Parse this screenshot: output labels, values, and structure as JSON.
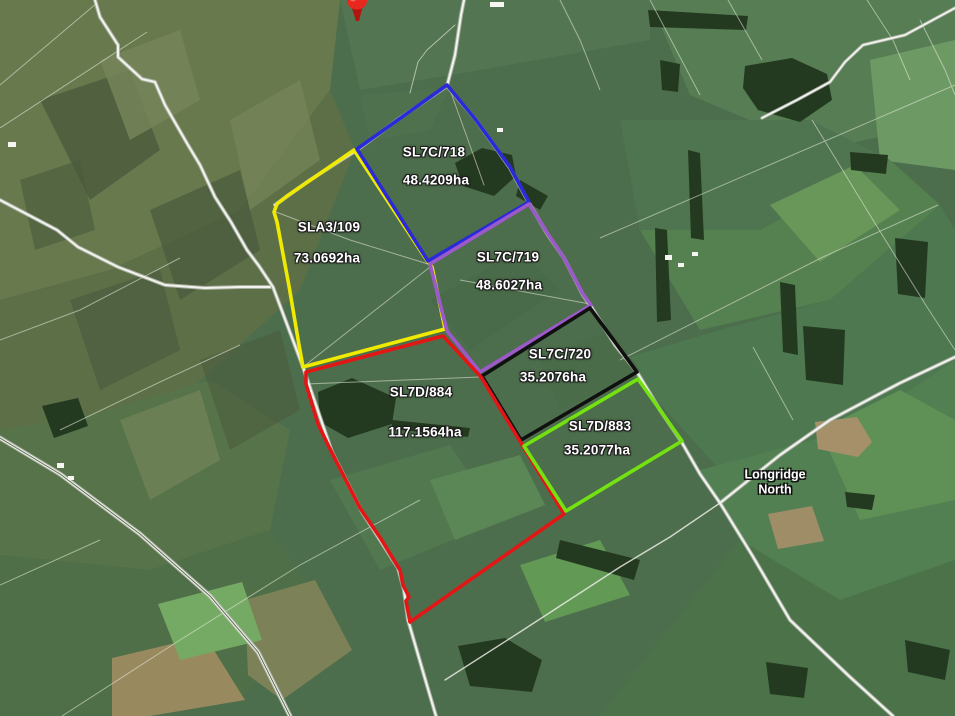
{
  "place_label": {
    "lines": [
      "Longridge",
      "North"
    ],
    "x": 775,
    "y": 482
  },
  "marker": {
    "name": "red-map-pin",
    "color": "#e8281e",
    "x": 357,
    "y": 2
  },
  "label_style": {
    "text_color": "#ffffff",
    "halo_color": "#111111"
  },
  "parcels": [
    {
      "id": "SLA3/109",
      "area": "73.0692ha",
      "outline_color": "#f0ea00",
      "id_pos": {
        "x": 329,
        "y": 227
      },
      "area_pos": {
        "x": 327,
        "y": 258
      },
      "polygon": [
        [
          354,
          150
        ],
        [
          428,
          262
        ],
        [
          432,
          267
        ],
        [
          445,
          329
        ],
        [
          303,
          367
        ],
        [
          299,
          345
        ],
        [
          289,
          286
        ],
        [
          277,
          222
        ],
        [
          274,
          212
        ],
        [
          277,
          204
        ],
        [
          287,
          196
        ],
        [
          312,
          179
        ]
      ]
    },
    {
      "id": "SL7C/718",
      "area": "48.4209ha",
      "outline_color": "#2a2ad8",
      "id_pos": {
        "x": 434,
        "y": 152
      },
      "area_pos": {
        "x": 436,
        "y": 180
      },
      "polygon": [
        [
          447,
          85
        ],
        [
          476,
          120
        ],
        [
          510,
          167
        ],
        [
          529,
          202
        ],
        [
          428,
          261
        ],
        [
          357,
          149
        ]
      ]
    },
    {
      "id": "SL7C/719",
      "area": "48.6027ha",
      "outline_color": "#9b59c9",
      "id_pos": {
        "x": 508,
        "y": 257
      },
      "area_pos": {
        "x": 509,
        "y": 285
      },
      "polygon": [
        [
          430,
          264
        ],
        [
          529,
          204
        ],
        [
          548,
          234
        ],
        [
          564,
          258
        ],
        [
          583,
          294
        ],
        [
          591,
          305
        ],
        [
          480,
          372
        ],
        [
          447,
          331
        ]
      ]
    },
    {
      "id": "SL7C/720",
      "area": "35.2076ha",
      "outline_color": "#101010",
      "id_pos": {
        "x": 560,
        "y": 354
      },
      "area_pos": {
        "x": 553,
        "y": 377
      },
      "polygon": [
        [
          482,
          376
        ],
        [
          590,
          308
        ],
        [
          637,
          372
        ],
        [
          521,
          440
        ]
      ]
    },
    {
      "id": "SL7D/884",
      "area": "117.1564ha",
      "outline_color": "#e31616",
      "id_pos": {
        "x": 421,
        "y": 392
      },
      "area_pos": {
        "x": 425,
        "y": 432
      },
      "polygon": [
        [
          306,
          372
        ],
        [
          443,
          336
        ],
        [
          481,
          377
        ],
        [
          521,
          443
        ],
        [
          564,
          514
        ],
        [
          410,
          622
        ],
        [
          406,
          601
        ],
        [
          409,
          597
        ],
        [
          403,
          585
        ],
        [
          400,
          570
        ],
        [
          381,
          539
        ],
        [
          360,
          508
        ],
        [
          331,
          451
        ],
        [
          318,
          424
        ],
        [
          306,
          384
        ]
      ]
    },
    {
      "id": "SL7D/883",
      "area": "35.2077ha",
      "outline_color": "#74e211",
      "id_pos": {
        "x": 600,
        "y": 426
      },
      "area_pos": {
        "x": 597,
        "y": 450
      },
      "polygon": [
        [
          524,
          446
        ],
        [
          638,
          379
        ],
        [
          682,
          441
        ],
        [
          566,
          511
        ]
      ]
    }
  ]
}
